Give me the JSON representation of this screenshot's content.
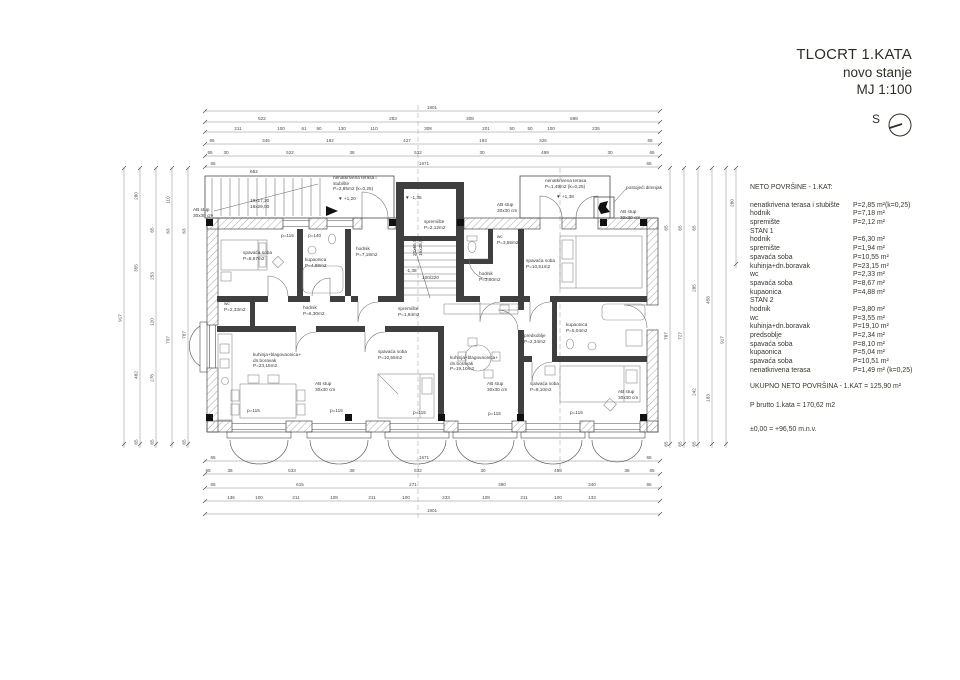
{
  "title_block": {
    "line1": "TLOCRT 1.KATA",
    "line2": "novo stanje",
    "line3": "MJ 1:100",
    "compass_label": "S"
  },
  "areas_panel": {
    "heading": "NETO POVRŠINE - 1.KAT:",
    "rows": [
      {
        "label": "nenatkrivena terasa i stubište",
        "value": "P=2,85 m²(k=0,25)"
      },
      {
        "label": "hodnik",
        "value": "P=7,18 m²"
      },
      {
        "label": "spremište",
        "value": "P=2,12 m²"
      },
      {
        "label": "STAN 1",
        "value": ""
      },
      {
        "label": "hodnik",
        "value": "P=6,30 m²"
      },
      {
        "label": "spremište",
        "value": "P=1,94 m²"
      },
      {
        "label": "spavaća soba",
        "value": "P=10,55 m²"
      },
      {
        "label": "kuhinja+dn.boravak",
        "value": "P=23,15 m²"
      },
      {
        "label": "wc",
        "value": "P=2,33 m²"
      },
      {
        "label": "spavaća soba",
        "value": "P=8,67 m²"
      },
      {
        "label": "kupaonica",
        "value": "P=4,88 m²"
      },
      {
        "label": "STAN 2",
        "value": ""
      },
      {
        "label": "hodnik",
        "value": "P=3,80 m²"
      },
      {
        "label": "wc",
        "value": "P=3,55 m²"
      },
      {
        "label": "kuhinja+dn.boravak",
        "value": "P=19,10 m²"
      },
      {
        "label": "predsoblje",
        "value": "P=2,34 m²"
      },
      {
        "label": "spavaća soba",
        "value": "P=8,10 m²"
      },
      {
        "label": "kupaonica",
        "value": "P=5,04 m²"
      },
      {
        "label": "spavaća soba",
        "value": "P=10,51 m²"
      },
      {
        "label": "nenatkrivena terasa",
        "value": "P=1,49 m² (k=0,25)"
      }
    ],
    "total": "UKUPNO NETO POVRŠINA - 1.KAT = 125,90 m²",
    "brutto": "P brutto 1.kata = 170,62 m2",
    "level": "±0,00 =  +96,50 m.n.v."
  },
  "plan": {
    "rooms": [
      {
        "lines": [
          "spavaća soba",
          "P=8,67m2"
        ],
        "x": 243,
        "y": 250
      },
      {
        "lines": [
          "kupaonica",
          "P=4,88m2"
        ],
        "x": 305,
        "y": 257
      },
      {
        "lines": [
          "hodnik",
          "P=7,18m2"
        ],
        "x": 356,
        "y": 246
      },
      {
        "lines": [
          "spremište",
          "P=2,12m2"
        ],
        "x": 424,
        "y": 219
      },
      {
        "lines": [
          "wc",
          "P=3,55m2"
        ],
        "x": 497,
        "y": 234
      },
      {
        "lines": [
          "hodnik",
          "P=3,80m2"
        ],
        "x": 479,
        "y": 271
      },
      {
        "lines": [
          "spavaća soba",
          "P=10,51m2"
        ],
        "x": 526,
        "y": 258
      },
      {
        "lines": [
          "wc",
          "P=2,33m2"
        ],
        "x": 224,
        "y": 301
      },
      {
        "lines": [
          "hodnik",
          "P=6,30m2"
        ],
        "x": 303,
        "y": 305
      },
      {
        "lines": [
          "spremište",
          "P=1,94m2"
        ],
        "x": 398,
        "y": 306
      },
      {
        "lines": [
          "kuhinja+blagovaonica+",
          "dn.boravak",
          "P=23,15m2"
        ],
        "x": 253,
        "y": 352
      },
      {
        "lines": [
          "spavaća soba",
          "P=10,55m2"
        ],
        "x": 378,
        "y": 349
      },
      {
        "lines": [
          "kuhinja+blagovaonica+",
          "dn.boravak",
          "P=19,10m2"
        ],
        "x": 450,
        "y": 355
      },
      {
        "lines": [
          "predsoblje",
          "P=2,34m2"
        ],
        "x": 524,
        "y": 333
      },
      {
        "lines": [
          "kupaonica",
          "P=5,04m2"
        ],
        "x": 566,
        "y": 322
      },
      {
        "lines": [
          "spavaća soba",
          "P=8,10m2"
        ],
        "x": 530,
        "y": 381
      }
    ],
    "annotations": [
      {
        "lines": [
          "nenatkrivena terasa i",
          "stubište",
          "P=2,85m2 (k=0,25)"
        ],
        "x": 333,
        "y": 175
      },
      {
        "lines": [
          "nenatkrivena terasa",
          "P=1,49m2 (k=0,25)"
        ],
        "x": 545,
        "y": 178
      },
      {
        "lines": [
          "postojeći dimnjak"
        ],
        "x": 626,
        "y": 185
      },
      {
        "lines": [
          "AB stup",
          "30x30 cm"
        ],
        "x": 193,
        "y": 207
      },
      {
        "lines": [
          "AB stup",
          "30x30 cm"
        ],
        "x": 497,
        "y": 202
      },
      {
        "lines": [
          "AB stup",
          "30x30 cm"
        ],
        "x": 620,
        "y": 209
      },
      {
        "lines": [
          "AB stup",
          "30x30 cm"
        ],
        "x": 315,
        "y": 381
      },
      {
        "lines": [
          "AB stup",
          "30x30 cm"
        ],
        "x": 487,
        "y": 381
      },
      {
        "lines": [
          "AB stup",
          "30x30 cm"
        ],
        "x": 618,
        "y": 389
      },
      {
        "lines": [
          "19x17,20",
          "18x29,00"
        ],
        "x": 250,
        "y": 198
      },
      {
        "lines": [
          "20x16,50",
          "16x28,00"
        ],
        "x": 412,
        "y": 256,
        "rot": -90
      },
      {
        "lines": [
          "▼ +1,20"
        ],
        "x": 338,
        "y": 196
      },
      {
        "lines": [
          "▼ -1,35"
        ],
        "x": 405,
        "y": 195
      },
      {
        "lines": [
          "▼ +1,38"
        ],
        "x": 556,
        "y": 194
      },
      {
        "lines": [
          "▼ -1,38"
        ],
        "x": 400,
        "y": 268
      },
      {
        "lines": [
          "p=115"
        ],
        "x": 281,
        "y": 233
      },
      {
        "lines": [
          "p=140"
        ],
        "x": 308,
        "y": 233
      },
      {
        "lines": [
          "p=115"
        ],
        "x": 247,
        "y": 408
      },
      {
        "lines": [
          "p=115"
        ],
        "x": 330,
        "y": 408
      },
      {
        "lines": [
          "p=115"
        ],
        "x": 413,
        "y": 410
      },
      {
        "lines": [
          "p=115"
        ],
        "x": 488,
        "y": 411
      },
      {
        "lines": [
          "p=115"
        ],
        "x": 570,
        "y": 410
      },
      {
        "lines": [
          "652"
        ],
        "x": 250,
        "y": 169
      },
      {
        "lines": [
          "100/220"
        ],
        "x": 422,
        "y": 275
      }
    ],
    "dims_h": [
      {
        "y": 111,
        "items": [
          {
            "t": "1801",
            "x": 432
          }
        ]
      },
      {
        "y": 122,
        "items": [
          {
            "t": "522",
            "x": 262
          },
          {
            "t": "283",
            "x": 393
          },
          {
            "t": "308",
            "x": 470
          },
          {
            "t": "698",
            "x": 574
          }
        ]
      },
      {
        "y": 132,
        "items": [
          {
            "t": "211",
            "x": 238
          },
          {
            "t": "100",
            "x": 281
          },
          {
            "t": "61",
            "x": 304
          },
          {
            "t": "50",
            "x": 319
          },
          {
            "t": "130",
            "x": 342
          },
          {
            "t": "110",
            "x": 374
          },
          {
            "t": "308",
            "x": 428
          },
          {
            "t": "201",
            "x": 486
          },
          {
            "t": "50",
            "x": 512
          },
          {
            "t": "50",
            "x": 530
          },
          {
            "t": "100",
            "x": 551
          },
          {
            "t": "235",
            "x": 596
          }
        ]
      },
      {
        "y": 144,
        "items": [
          {
            "t": "65",
            "x": 212
          },
          {
            "t": "345",
            "x": 266
          },
          {
            "t": "192",
            "x": 330
          },
          {
            "t": "427",
            "x": 407
          },
          {
            "t": "183",
            "x": 483
          },
          {
            "t": "326",
            "x": 543
          },
          {
            "t": "65",
            "x": 650
          }
        ]
      },
      {
        "y": 156,
        "items": [
          {
            "t": "65",
            "x": 210
          },
          {
            "t": "30",
            "x": 226
          },
          {
            "t": "522",
            "x": 290
          },
          {
            "t": "38",
            "x": 352
          },
          {
            "t": "532",
            "x": 418
          },
          {
            "t": "30",
            "x": 482
          },
          {
            "t": "499",
            "x": 545
          },
          {
            "t": "30",
            "x": 610
          },
          {
            "t": "65",
            "x": 652
          }
        ]
      },
      {
        "y": 167,
        "items": [
          {
            "t": "65",
            "x": 213
          },
          {
            "t": "1671",
            "x": 424
          },
          {
            "t": "65",
            "x": 649
          }
        ]
      },
      {
        "y": 461,
        "items": [
          {
            "t": "65",
            "x": 213
          },
          {
            "t": "1671",
            "x": 424
          },
          {
            "t": "65",
            "x": 649
          }
        ]
      },
      {
        "y": 474,
        "items": [
          {
            "t": "65",
            "x": 208
          },
          {
            "t": "38",
            "x": 230
          },
          {
            "t": "533",
            "x": 292
          },
          {
            "t": "38",
            "x": 352
          },
          {
            "t": "532",
            "x": 418
          },
          {
            "t": "30",
            "x": 483
          },
          {
            "t": "498",
            "x": 558
          },
          {
            "t": "38",
            "x": 627
          },
          {
            "t": "65",
            "x": 652
          }
        ]
      },
      {
        "y": 488,
        "items": [
          {
            "t": "65",
            "x": 213
          },
          {
            "t": "615",
            "x": 300
          },
          {
            "t": "271",
            "x": 413
          },
          {
            "t": "390",
            "x": 502
          },
          {
            "t": "340",
            "x": 592
          },
          {
            "t": "65",
            "x": 649
          }
        ]
      },
      {
        "y": 501,
        "items": [
          {
            "t": "136",
            "x": 231
          },
          {
            "t": "100",
            "x": 259
          },
          {
            "t": "211",
            "x": 296
          },
          {
            "t": "108",
            "x": 334
          },
          {
            "t": "211",
            "x": 372
          },
          {
            "t": "100",
            "x": 406
          },
          {
            "t": "233",
            "x": 446
          },
          {
            "t": "108",
            "x": 486
          },
          {
            "t": "211",
            "x": 524
          },
          {
            "t": "100",
            "x": 558
          },
          {
            "t": "133",
            "x": 592
          }
        ]
      },
      {
        "y": 514,
        "items": [
          {
            "t": "1801",
            "x": 432
          }
        ]
      }
    ],
    "dims_v": [
      {
        "x": 124,
        "items": [
          {
            "t": "917",
            "y": 318
          }
        ]
      },
      {
        "x": 140,
        "items": [
          {
            "t": "280",
            "y": 196
          },
          {
            "t": "355",
            "y": 268
          },
          {
            "t": "482",
            "y": 375
          },
          {
            "t": "65",
            "y": 442
          }
        ]
      },
      {
        "x": 156,
        "items": [
          {
            "t": "65",
            "y": 230
          },
          {
            "t": "253",
            "y": 276
          },
          {
            "t": "120",
            "y": 322
          },
          {
            "t": "278",
            "y": 378
          },
          {
            "t": "65",
            "y": 442
          }
        ]
      },
      {
        "x": 172,
        "items": [
          {
            "t": "110",
            "y": 200
          },
          {
            "t": "63",
            "y": 231
          },
          {
            "t": "737",
            "y": 340
          }
        ]
      },
      {
        "x": 188,
        "items": [
          {
            "t": "63",
            "y": 231
          },
          {
            "t": "787",
            "y": 335
          },
          {
            "t": "65",
            "y": 442
          }
        ]
      },
      {
        "x": 670,
        "items": [
          {
            "t": "65",
            "y": 228
          },
          {
            "t": "787",
            "y": 336
          },
          {
            "t": "65",
            "y": 444
          }
        ]
      },
      {
        "x": 684,
        "items": [
          {
            "t": "65",
            "y": 228
          },
          {
            "t": "727",
            "y": 336
          },
          {
            "t": "65",
            "y": 444
          }
        ]
      },
      {
        "x": 698,
        "items": [
          {
            "t": "65",
            "y": 228
          },
          {
            "t": "285",
            "y": 288
          },
          {
            "t": "242",
            "y": 392
          },
          {
            "t": "65",
            "y": 444
          }
        ]
      },
      {
        "x": 712,
        "items": [
          {
            "t": "458",
            "y": 300
          },
          {
            "t": "183",
            "y": 398
          }
        ]
      },
      {
        "x": 726,
        "items": [
          {
            "t": "917",
            "y": 340
          }
        ]
      },
      {
        "x": 736,
        "items": [
          {
            "t": "280",
            "y": 203
          }
        ]
      }
    ]
  }
}
